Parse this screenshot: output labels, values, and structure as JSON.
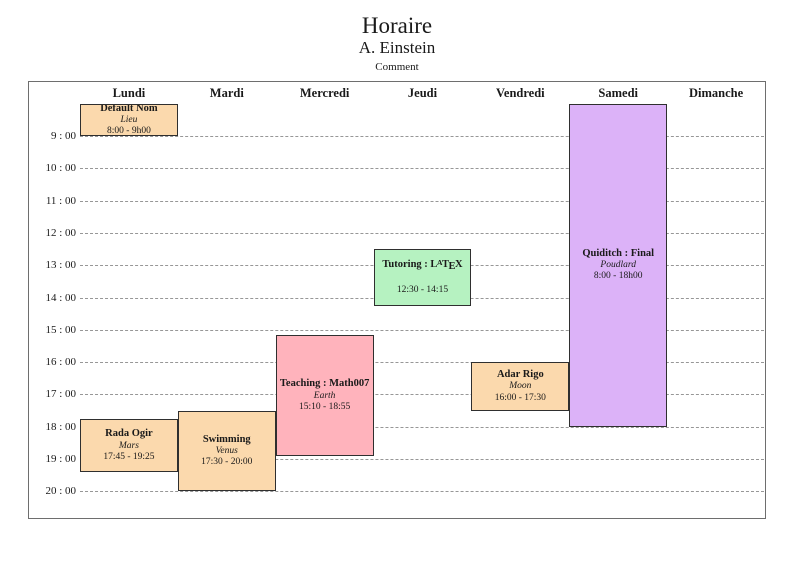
{
  "page": {
    "title": "Horaire",
    "author": "A. Einstein",
    "comment": "Comment"
  },
  "colors": {
    "orange": "#FBD9AD",
    "red": "#FFB3BC",
    "green": "#B6F2C1",
    "violet": "#DCB2F8",
    "event_border": "#2f2f2f",
    "grid_line": "#979797",
    "frame_border": "#6e6e6e"
  },
  "chart_data": {
    "type": "table",
    "title": "Horaire",
    "x_categories_days": [
      "Lundi",
      "Mardi",
      "Mercredi",
      "Jeudi",
      "Vendredi",
      "Samedi",
      "Dimanche"
    ],
    "y_tick_labels_hours": [
      "9 : 00",
      "10 : 00",
      "11 : 00",
      "12 : 00",
      "13 : 00",
      "14 : 00",
      "15 : 00",
      "16 : 00",
      "17 : 00",
      "18 : 00",
      "19 : 00",
      "20 : 00"
    ],
    "time_axis_range_hours": [
      8,
      20.8
    ],
    "grid": "dashed horizontal hour lines",
    "events": [
      {
        "title": "Default Nom",
        "location": "Lieu",
        "time_label": "8:00 - 9h00",
        "day": "Lundi",
        "day_index": 0,
        "start_hour": 8,
        "end_hour": 9,
        "color": "orange",
        "latex_logo": false
      },
      {
        "title": "Rada Ogir",
        "location": "Mars",
        "time_label": "17:45 - 19:25",
        "day": "Lundi",
        "day_index": 0,
        "start_hour": 17.75,
        "end_hour": 19.4167,
        "color": "orange",
        "latex_logo": false
      },
      {
        "title": "Swimming",
        "location": "Venus",
        "time_label": "17:30 - 20:00",
        "day": "Mardi",
        "day_index": 1,
        "start_hour": 17.5,
        "end_hour": 20,
        "color": "orange",
        "latex_logo": false
      },
      {
        "title": "Teaching : Math007",
        "location": "Earth",
        "time_label": "15:10 - 18:55",
        "day": "Mercredi",
        "day_index": 2,
        "start_hour": 15.1667,
        "end_hour": 18.9167,
        "color": "red",
        "latex_logo": false
      },
      {
        "title": "Tutoring : LaTeX",
        "location": "",
        "time_label": "12:30 - 14:15",
        "day": "Jeudi",
        "day_index": 3,
        "start_hour": 12.5,
        "end_hour": 14.25,
        "color": "green",
        "latex_logo": true
      },
      {
        "title": "Adar Rigo",
        "location": "Moon",
        "time_label": "16:00 - 17:30",
        "day": "Vendredi",
        "day_index": 4,
        "start_hour": 16,
        "end_hour": 17.5,
        "color": "orange",
        "latex_logo": false
      },
      {
        "title": "Quiditch : Final",
        "location": "Poudlard",
        "time_label": "8:00 - 18h00",
        "day": "Samedi",
        "day_index": 5,
        "start_hour": 8,
        "end_hour": 18,
        "color": "violet",
        "latex_logo": false
      }
    ]
  }
}
